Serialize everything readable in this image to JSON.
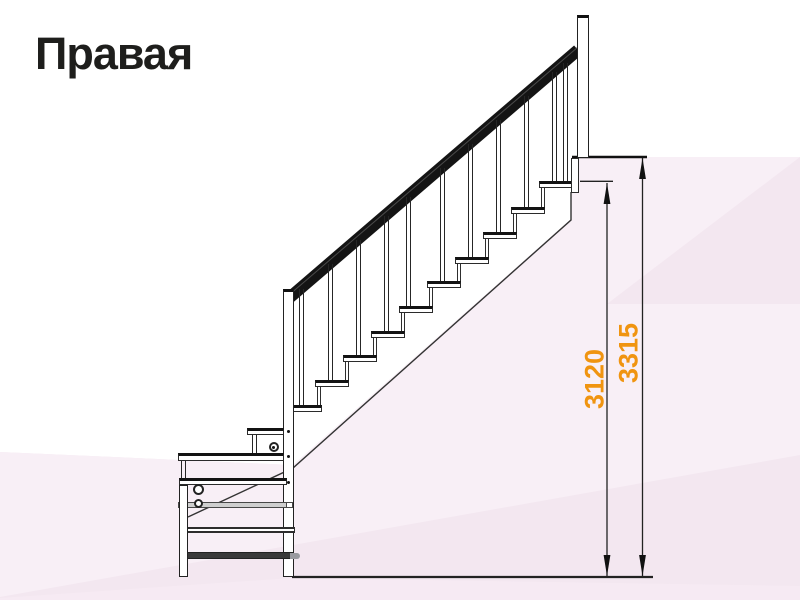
{
  "title": "Правая",
  "diagram": {
    "type": "staircase-side-elevation",
    "description_visible_elements": [
      "handrail",
      "balusters",
      "treads",
      "newel-posts",
      "dimension-lines"
    ],
    "dimensions": [
      {
        "id": "height-to-top-step",
        "value": "3120"
      },
      {
        "id": "height-to-upper-floor",
        "value": "3315"
      }
    ],
    "colors": {
      "dimension_text": "#f09410",
      "line_color": "#1e1e1c",
      "background_base": "#ffffff",
      "background_pink_light": "#f8eff6",
      "background_pink_mid": "#f3e7f0",
      "background_pink_deep": "#f2e4ee"
    }
  }
}
